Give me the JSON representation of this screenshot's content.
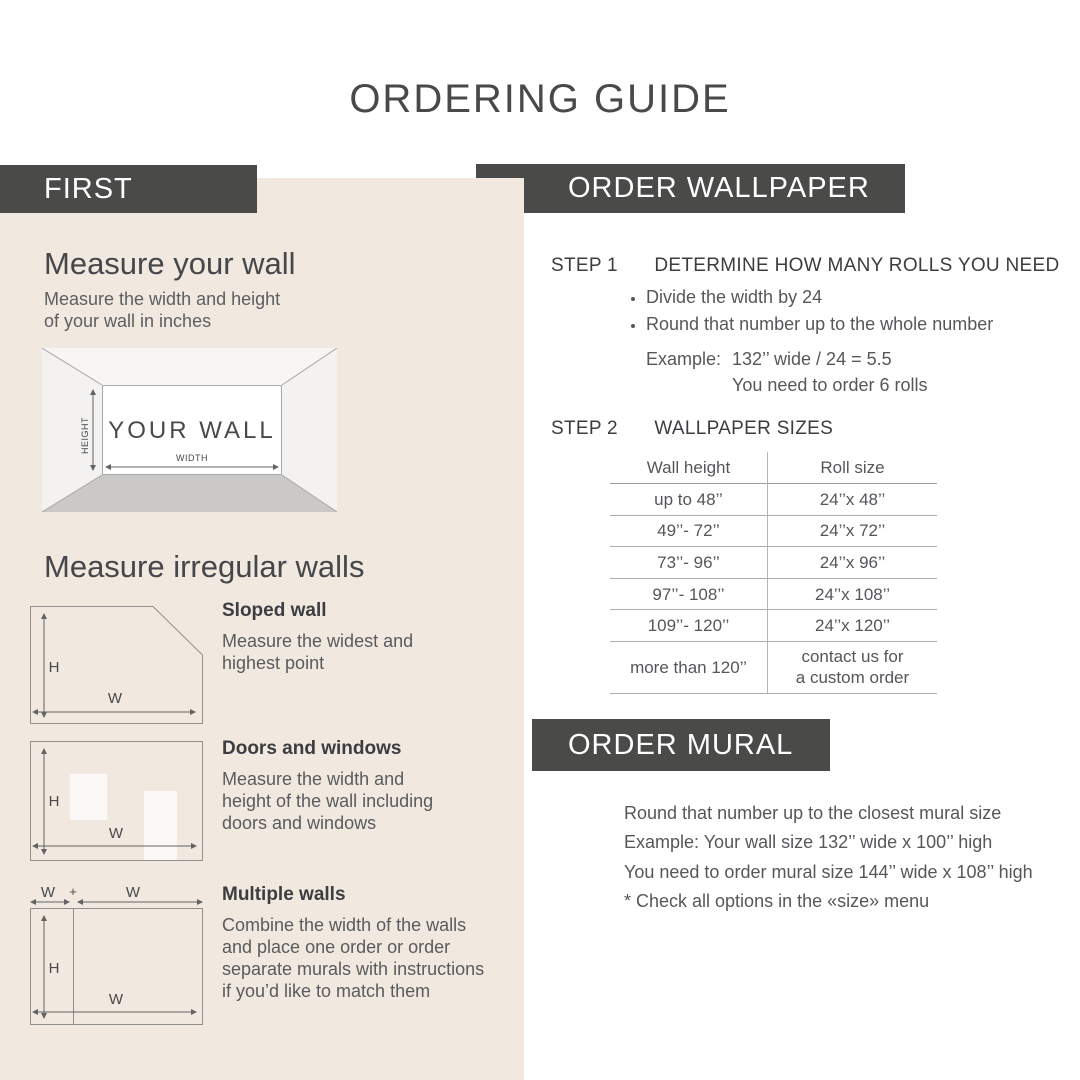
{
  "title": "ORDERING GUIDE",
  "colors": {
    "bar_background": "#4a4a49",
    "panel_beige": "#f1e8df",
    "heading_text": "#45474a",
    "body_text": "#55575a",
    "table_line": "#ababab",
    "floor_gray": "#cac9c7"
  },
  "first_panel": {
    "header": "FIRST",
    "measure_wall": {
      "heading": "Measure your wall",
      "subtext": "Measure the width and height\nof your wall in inches",
      "diagram": {
        "your_wall": "YOUR WALL",
        "height_label": "HEIGHT",
        "width_label": "WIDTH"
      }
    },
    "irregular": {
      "heading": "Measure irregular walls",
      "sloped": {
        "title": "Sloped wall",
        "description": "Measure the widest and\nhighest point",
        "h_label": "H",
        "w_label": "W"
      },
      "doors": {
        "title": "Doors and windows",
        "description": "Measure the width and\nheight of the wall including\ndoors and windows",
        "h_label": "H",
        "w_label": "W"
      },
      "multiple": {
        "title": "Multiple walls",
        "description": "Combine the width of the walls\nand place one order or order\nseparate murals with instructions\nif you’d like to match them",
        "w1_label": "W",
        "plus_label": "+",
        "w2_label": "W",
        "h_label": "H",
        "w_label": "W"
      }
    }
  },
  "order_wallpaper": {
    "header": "ORDER WALLPAPER",
    "step1": {
      "label": "STEP 1",
      "title": "DETERMINE HOW MANY ROLLS YOU NEED",
      "bullets": [
        "Divide the width by 24",
        "Round that number up to the whole number"
      ],
      "example_label": "Example:",
      "example_line1": "132’’ wide / 24 = 5.5",
      "example_line2": "You need to order 6 rolls"
    },
    "step2": {
      "label": "STEP 2",
      "title": "WALLPAPER SIZES",
      "table": {
        "col1_header": "Wall height",
        "col2_header": "Roll size",
        "rows": [
          {
            "wall": "up to 48’’",
            "roll": "24’’x 48’’"
          },
          {
            "wall": "49’’- 72’’",
            "roll": "24’’x 72’’"
          },
          {
            "wall": "73’’- 96’’",
            "roll": "24’’x 96’’"
          },
          {
            "wall": "97’’- 108’’",
            "roll": "24’’x 108’’"
          },
          {
            "wall": "109’’- 120’’",
            "roll": "24’’x 120’’"
          },
          {
            "wall": "more than 120’’",
            "roll": "contact us for\na custom order"
          }
        ]
      }
    }
  },
  "order_mural": {
    "header": "ORDER MURAL",
    "lines": [
      "Round that number up to the closest mural size",
      "Example: Your wall size 132’’ wide x 100’’ high",
      "You need to order mural size 144’’ wide x 108’’ high",
      "* Check all options in the «size» menu"
    ]
  }
}
